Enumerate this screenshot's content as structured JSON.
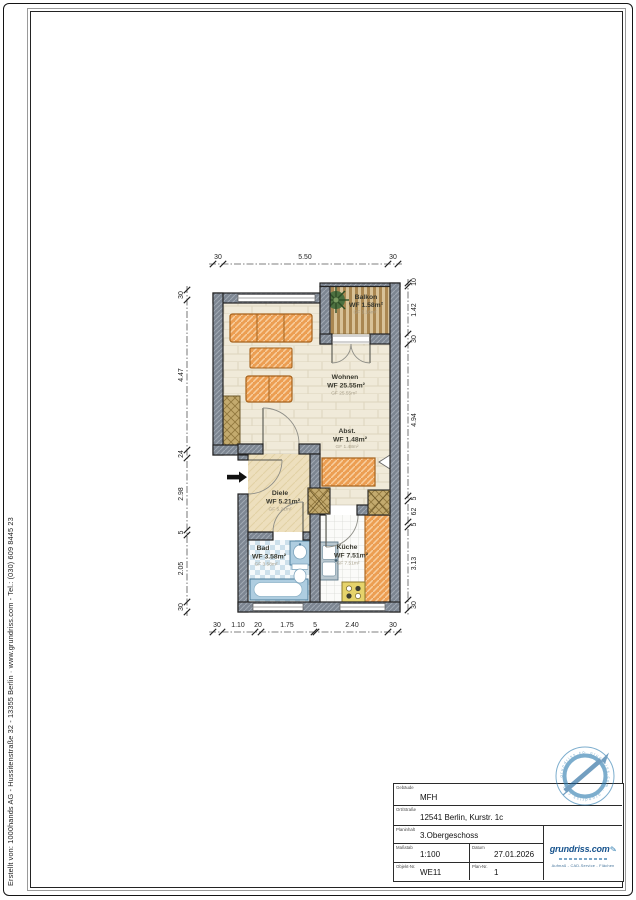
{
  "page": {
    "credit_line": "Erstellt von:   1000hands AG - Hussitenstraße 32 - 13355 Berlin   ·   www.grundriss.com   -   Tel.: (030) 609 8445 23"
  },
  "plan": {
    "rooms": [
      {
        "name": "Balkon",
        "wf": "WF 1.58m²",
        "gf": "GF 3.16m²"
      },
      {
        "name": "Wohnen",
        "wf": "WF 25.55m²",
        "gf": "GF 25.55m²"
      },
      {
        "name": "Abst.",
        "wf": "WF 1.48m²",
        "gf": "GF 1.48m²"
      },
      {
        "name": "Diele",
        "wf": "WF 5.21m²",
        "gf": "GF 5.21m²"
      },
      {
        "name": "Bad",
        "wf": "WF 3.58m²",
        "gf": "GF 3.58m²"
      },
      {
        "name": "Küche",
        "wf": "WF 7.51m²",
        "gf": "GF 7.51m²"
      }
    ],
    "dimensions": {
      "top": [
        "30",
        "5.50",
        "30"
      ],
      "bottom": [
        "30",
        "1.10",
        "20",
        "1.75",
        "5",
        "2.40",
        "30"
      ],
      "left": [
        "30",
        "4.47",
        "24",
        "2.98",
        "5",
        "2.05",
        "30"
      ],
      "right": [
        "10",
        "1.42",
        "30",
        "4.94",
        "5",
        "62",
        "5",
        "3.13",
        "30"
      ]
    }
  },
  "title_block": {
    "fields": [
      {
        "label": "Gebäude",
        "value": "MFH"
      },
      {
        "label": "Ort/Straße",
        "value": "12541 Berlin, Kurstr. 1c"
      },
      {
        "label": "Planinhalt",
        "value": "3.Obergeschoss"
      },
      {
        "label": "Maßstab",
        "value": "1:100"
      },
      {
        "label": "Datum",
        "value": "27.01.2026"
      },
      {
        "label": "Objekt-Nr.",
        "value": "WE11"
      },
      {
        "label": "Plan-Nr.",
        "value": "1"
      }
    ],
    "logo": {
      "brand": "grundriss.com",
      "services": "Aufmaß - CAD-Service - Flächen"
    },
    "stamp_ring_text": "· grundriss.com · grundriss.com · grundriss.com"
  },
  "colors": {
    "wall_gray": "#7d8692",
    "furniture_orange": "#ec9e52",
    "cabinet_khaki": "#c3aa6e",
    "fixture_blue": "#aecde0",
    "deck_tan": "#d8c298",
    "brand_blue": "#17538d",
    "stamp_blue": "#2d7cb0"
  }
}
